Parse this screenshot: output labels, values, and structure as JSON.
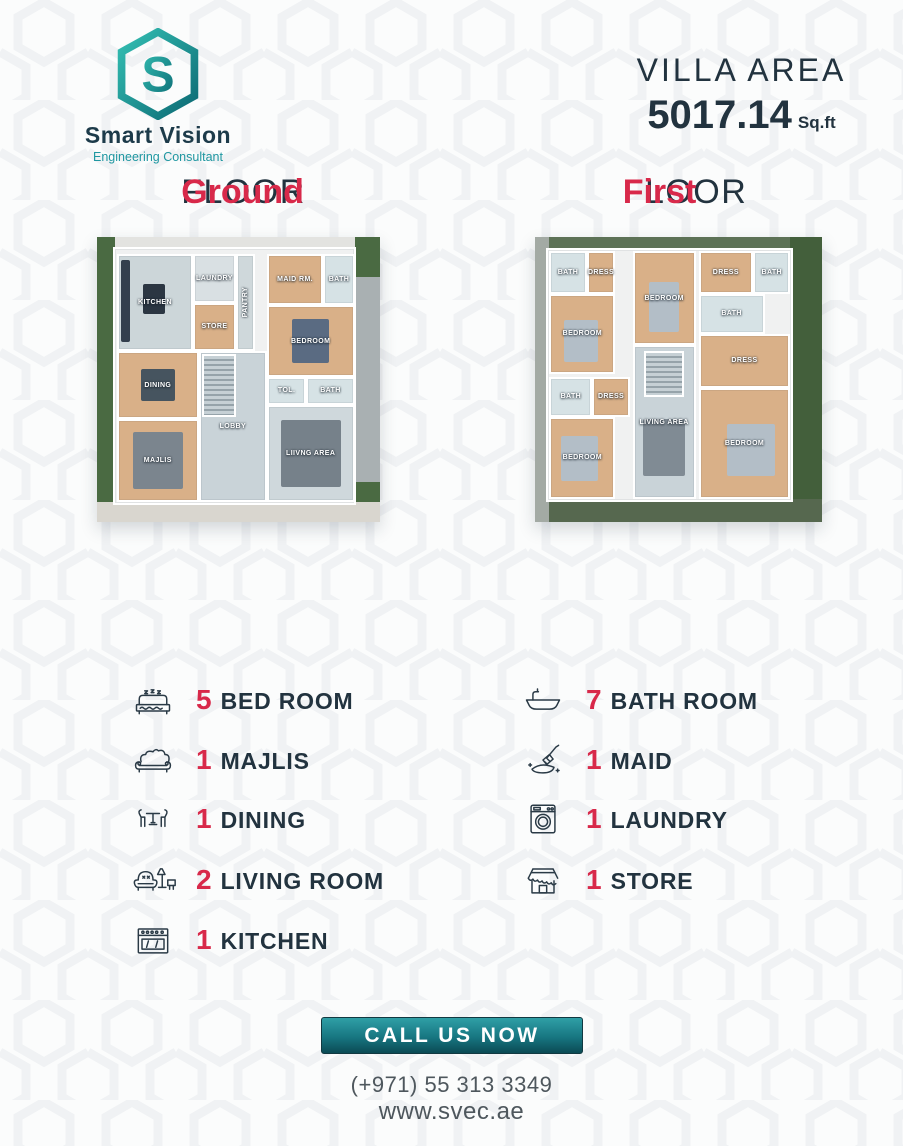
{
  "brand": {
    "name": "Smart Vision",
    "tagline": "Engineering Consultant"
  },
  "villa_area": {
    "label": "VILLA AREA",
    "value": "5017.14",
    "unit": "Sq.ft"
  },
  "colors": {
    "accent_red": "#d8294a",
    "navy": "#22333f",
    "teal": "#1f97a1",
    "button_teal_dark": "#0b4a54"
  },
  "floors": [
    {
      "id": "ground",
      "title_accent": "Ground",
      "title_rest": "FLOOR",
      "layers": [
        {
          "name": "garden-left",
          "x": 0,
          "y": 0,
          "w": 6.5,
          "h": 100,
          "fill": "#4a6a42"
        },
        {
          "name": "path-right",
          "x": 91,
          "y": 0,
          "w": 9,
          "h": 100,
          "fill": "#a9b0b2"
        },
        {
          "name": "garden-right-top",
          "x": 91,
          "y": 0,
          "w": 9,
          "h": 14,
          "fill": "#4a6a42"
        },
        {
          "name": "garden-right-bottom",
          "x": 91,
          "y": 86,
          "w": 9,
          "h": 14,
          "fill": "#4a6a42"
        },
        {
          "name": "path-bottom",
          "x": 0,
          "y": 93,
          "w": 100,
          "h": 7,
          "fill": "#d9d6cf"
        },
        {
          "name": "path-top",
          "x": 6.5,
          "y": 0,
          "w": 84.5,
          "h": 5,
          "fill": "#e3e3e0"
        },
        {
          "name": "house-base",
          "x": 5.5,
          "y": 3.5,
          "w": 86,
          "h": 90.5,
          "fill": "#f0f1f1",
          "wall": true
        },
        {
          "name": "room-kitchen",
          "x": 7,
          "y": 6,
          "w": 27,
          "h": 34,
          "fill": "#ccd6d9",
          "label": "KITCHEN",
          "wall": true,
          "accents": [
            {
              "x": 3,
              "y": 4,
              "w": 12,
              "h": 88,
              "color": "#333f4d"
            },
            {
              "x": 34,
              "y": 30,
              "w": 30,
              "h": 32,
              "color": "#2b3642"
            }
          ]
        },
        {
          "name": "room-laundry",
          "x": 34,
          "y": 6,
          "w": 15,
          "h": 17,
          "fill": "#d9e0e3",
          "label": "LAUNDRY",
          "wall": true
        },
        {
          "name": "room-store",
          "x": 34,
          "y": 23,
          "w": 15,
          "h": 17,
          "fill": "#d9b088",
          "label": "STORE",
          "wall": true
        },
        {
          "name": "room-pantry",
          "x": 49,
          "y": 6,
          "w": 7,
          "h": 34,
          "fill": "#cfd8db",
          "label": "PANTRY",
          "vertical": true,
          "wall": true
        },
        {
          "name": "room-maid",
          "x": 60,
          "y": 6,
          "w": 20,
          "h": 18,
          "fill": "#d9b088",
          "label": "MAID RM.",
          "wall": true
        },
        {
          "name": "room-bath-top",
          "x": 80,
          "y": 6,
          "w": 11,
          "h": 18,
          "fill": "#d6e2e5",
          "label": "BATH",
          "wall": true
        },
        {
          "name": "room-bedroom",
          "x": 60,
          "y": 24,
          "w": 31,
          "h": 25,
          "fill": "#d9b088",
          "label": "BEDROOM",
          "wall": true,
          "accents": [
            {
              "x": 28,
              "y": 18,
              "w": 44,
              "h": 64,
              "color": "#5a6b82"
            }
          ]
        },
        {
          "name": "room-tol",
          "x": 60,
          "y": 49,
          "w": 14,
          "h": 10,
          "fill": "#d6e2e5",
          "label": "TOL.",
          "wall": true
        },
        {
          "name": "room-bath-mid",
          "x": 74,
          "y": 49,
          "w": 17,
          "h": 10,
          "fill": "#d6e2e5",
          "label": "BATH",
          "wall": true
        },
        {
          "name": "room-dining",
          "x": 7,
          "y": 40,
          "w": 29,
          "h": 24,
          "fill": "#d9b088",
          "label": "DINING",
          "wall": true,
          "accents": [
            {
              "x": 28,
              "y": 25,
              "w": 44,
              "h": 50,
              "color": "#46545f"
            }
          ]
        },
        {
          "name": "room-majlis",
          "x": 7,
          "y": 64,
          "w": 29,
          "h": 29,
          "fill": "#d9b088",
          "label": "MAJLIS",
          "wall": true,
          "accents": [
            {
              "x": 18,
              "y": 14,
              "w": 64,
              "h": 72,
              "color": "#7b858e"
            }
          ]
        },
        {
          "name": "room-lobby",
          "x": 36,
          "y": 40,
          "w": 24,
          "h": 53,
          "fill": "#c9d3d8",
          "label": "LOBBY",
          "wall": true
        },
        {
          "name": "room-living",
          "x": 60,
          "y": 59,
          "w": 31,
          "h": 34,
          "fill": "#cfd8dc",
          "label": "LIIVNG AREA",
          "wall": true,
          "accents": [
            {
              "x": 14,
              "y": 14,
              "w": 72,
              "h": 72,
              "color": "#76818a"
            }
          ]
        },
        {
          "name": "stairs",
          "x": 37,
          "y": 41,
          "w": 12,
          "h": 22,
          "stairs": true
        }
      ]
    },
    {
      "id": "first",
      "title_accent": "First",
      "title_rest": "FLOOR",
      "layers": [
        {
          "name": "garden-top",
          "x": 0,
          "y": 0,
          "w": 100,
          "h": 5,
          "fill": "#5d7256"
        },
        {
          "name": "garden-right",
          "x": 89,
          "y": 0,
          "w": 11,
          "h": 100,
          "fill": "#435f3b"
        },
        {
          "name": "garden-bottom",
          "x": 0,
          "y": 92,
          "w": 100,
          "h": 8,
          "fill": "#56684f"
        },
        {
          "name": "path-left",
          "x": 0,
          "y": 0,
          "w": 5,
          "h": 100,
          "fill": "#a3aaa4"
        },
        {
          "name": "house-base",
          "x": 4,
          "y": 4,
          "w": 86,
          "h": 89,
          "fill": "#f0f1f1",
          "wall": true
        },
        {
          "name": "room-bath-tl",
          "x": 5,
          "y": 5,
          "w": 13,
          "h": 15,
          "fill": "#d6e2e5",
          "label": "BATH",
          "wall": true
        },
        {
          "name": "room-dress-tl",
          "x": 18,
          "y": 5,
          "w": 10,
          "h": 15,
          "fill": "#d9b088",
          "label": "DRESS",
          "wall": true
        },
        {
          "name": "room-bedroom-l",
          "x": 5,
          "y": 20,
          "w": 23,
          "h": 28,
          "fill": "#d9b088",
          "label": "BEDROOM",
          "wall": true,
          "accents": [
            {
              "x": 20,
              "y": 32,
              "w": 55,
              "h": 55,
              "color": "#b3bec7"
            }
          ]
        },
        {
          "name": "room-bedroom-tm",
          "x": 34,
          "y": 5,
          "w": 22,
          "h": 33,
          "fill": "#d9b088",
          "label": "BEDROOM",
          "wall": true,
          "accents": [
            {
              "x": 25,
              "y": 32,
              "w": 50,
              "h": 55,
              "color": "#b3bec7"
            }
          ]
        },
        {
          "name": "room-dress-tr",
          "x": 57,
          "y": 5,
          "w": 19,
          "h": 15,
          "fill": "#d9b088",
          "label": "DRESS",
          "wall": true
        },
        {
          "name": "room-bath-tr",
          "x": 76,
          "y": 5,
          "w": 13,
          "h": 15,
          "fill": "#d6e2e5",
          "label": "BATH",
          "wall": true
        },
        {
          "name": "room-bath-r",
          "x": 57,
          "y": 20,
          "w": 23,
          "h": 14,
          "fill": "#d6e2e5",
          "label": "BATH",
          "wall": true
        },
        {
          "name": "room-dress-r",
          "x": 57,
          "y": 34,
          "w": 32,
          "h": 19,
          "fill": "#d9b088",
          "label": "DRESS",
          "wall": true
        },
        {
          "name": "room-bath-ml",
          "x": 5,
          "y": 49,
          "w": 15,
          "h": 14,
          "fill": "#d6e2e5",
          "label": "BATH",
          "wall": true
        },
        {
          "name": "room-dress-ml",
          "x": 20,
          "y": 49,
          "w": 13,
          "h": 14,
          "fill": "#d9b088",
          "label": "DRESS",
          "wall": true
        },
        {
          "name": "room-bedroom-bl",
          "x": 5,
          "y": 63,
          "w": 23,
          "h": 29,
          "fill": "#d9b088",
          "label": "BEDROOM",
          "wall": true,
          "accents": [
            {
              "x": 15,
              "y": 22,
              "w": 60,
              "h": 58,
              "color": "#b3bec7"
            }
          ]
        },
        {
          "name": "room-living",
          "x": 34,
          "y": 38,
          "w": 22,
          "h": 54,
          "fill": "#c9d3d8",
          "label": "LIVING AREA",
          "wall": true,
          "accents": [
            {
              "x": 15,
              "y": 48,
              "w": 70,
              "h": 38,
              "color": "#808b94"
            }
          ]
        },
        {
          "name": "room-bedroom-br",
          "x": 57,
          "y": 53,
          "w": 32,
          "h": 39,
          "fill": "#d9b088",
          "label": "BEDROOM",
          "wall": true,
          "accents": [
            {
              "x": 30,
              "y": 32,
              "w": 55,
              "h": 48,
              "color": "#b3bec7"
            }
          ]
        },
        {
          "name": "stairs",
          "x": 38,
          "y": 40,
          "w": 14,
          "h": 16,
          "stairs": true
        }
      ]
    }
  ],
  "features": {
    "left": [
      {
        "icon": "bed-icon",
        "count": "5",
        "label": "BED ROOM"
      },
      {
        "icon": "sofa-icon",
        "count": "1",
        "label": "MAJLIS"
      },
      {
        "icon": "dining-icon",
        "count": "1",
        "label": "DINING"
      },
      {
        "icon": "armchair-icon",
        "count": "2",
        "label": "LIVING ROOM"
      },
      {
        "icon": "stove-icon",
        "count": "1",
        "label": "KITCHEN"
      }
    ],
    "right": [
      {
        "icon": "bathtub-icon",
        "count": "7",
        "label": "BATH ROOM"
      },
      {
        "icon": "maid-icon",
        "count": "1",
        "label": "MAID"
      },
      {
        "icon": "washing-machine-icon",
        "count": "1",
        "label": "LAUNDRY"
      },
      {
        "icon": "store-icon",
        "count": "1",
        "label": "STORE"
      }
    ]
  },
  "cta": {
    "label": "CALL US NOW",
    "phone": "(+971) 55 313 3349",
    "website": "www.svec.ae"
  }
}
